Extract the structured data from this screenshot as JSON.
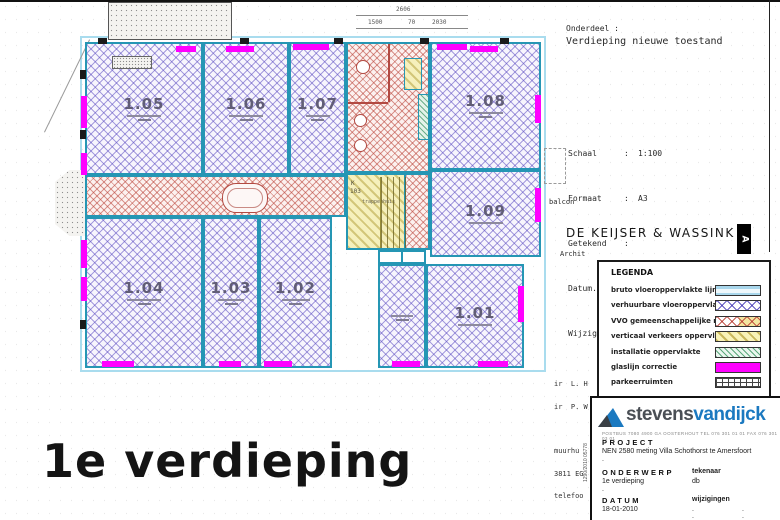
{
  "header": {
    "onderdeel_label": "Onderdeel :",
    "onderdeel_value": "Verdieping nieuwe toestand"
  },
  "info": {
    "colon": ":",
    "rows": [
      {
        "label": "Schaal",
        "value": "1:100"
      },
      {
        "label": "Formaat",
        "value": "A3"
      },
      {
        "label": "Getekend",
        "value": ""
      },
      {
        "label": "Datum.",
        "value": "30.09.88"
      },
      {
        "label": "Wijziging",
        "value": "31.10.88"
      }
    ],
    "balcon": "balcon"
  },
  "firm": {
    "name": "DE KEIJSER & WASSINK",
    "marker": "A",
    "fragment_archit": "Archit",
    "fragments": [
      "ir  L. H",
      "ir  P. W",
      "",
      "muurhu",
      "3811 EG",
      "telefoo"
    ]
  },
  "dimensions": {
    "total": "2606",
    "segments": [
      "1500",
      "70",
      "2030"
    ]
  },
  "plan": {
    "room_ids": [
      "1.05",
      "1.06",
      "1.07",
      "1.08",
      "1.09",
      "1.04",
      "1.03",
      "1.02",
      "1.01"
    ],
    "stair_k": "K",
    "stair_num": "103",
    "stair_name": "trappenhuis"
  },
  "legend": {
    "title": "LEGENDA",
    "items": [
      {
        "label": "bruto vloeroppervlakte lijn"
      },
      {
        "label": "verhuurbare vloeroppervlakte"
      },
      {
        "label": "VVO gemeenschappelijke ruimte"
      },
      {
        "label": "verticaal verkeers oppervlakte"
      },
      {
        "label": "installatie oppervlakte"
      },
      {
        "label": "glaslijn correctie"
      },
      {
        "label": "parkeerruimten"
      }
    ]
  },
  "titleblock": {
    "brand_part1": "stevens",
    "brand_part2": "vandijck",
    "address": "POSTBUS 7080  4900 GA OOSTERHOUT        TEL 076 301 01 01  FAX 076 301 03 01",
    "project_label": "PROJECT",
    "project_value": "NEN 2580 meting Villa Schothorst te Amersfoort",
    "dot": ".",
    "onderwerp_label": "ONDERWERP",
    "onderwerp_value": "1e verdieping",
    "tekenaar_label": "tekenaar",
    "tekenaar_value": "db",
    "datum_label": "DATUM",
    "datum_value": "18-01-2010",
    "wijzigingen_label": "wijzigingen",
    "side_code": "1290/2010 05778"
  },
  "footer": {
    "title": "1e verdieping"
  },
  "colors": {
    "glaslijn_correctie": "#ff00ff",
    "verhuurbaar_hatch": "#5a4cbe",
    "vvo_hatch": "#ba443a",
    "verticaal_geel": "#d8c84a",
    "installatie_groen": "#3f9e68",
    "wall_teal": "#2596b4",
    "bruto_lijn": "#a9dcee",
    "logo_blauw": "#1b79c0"
  }
}
